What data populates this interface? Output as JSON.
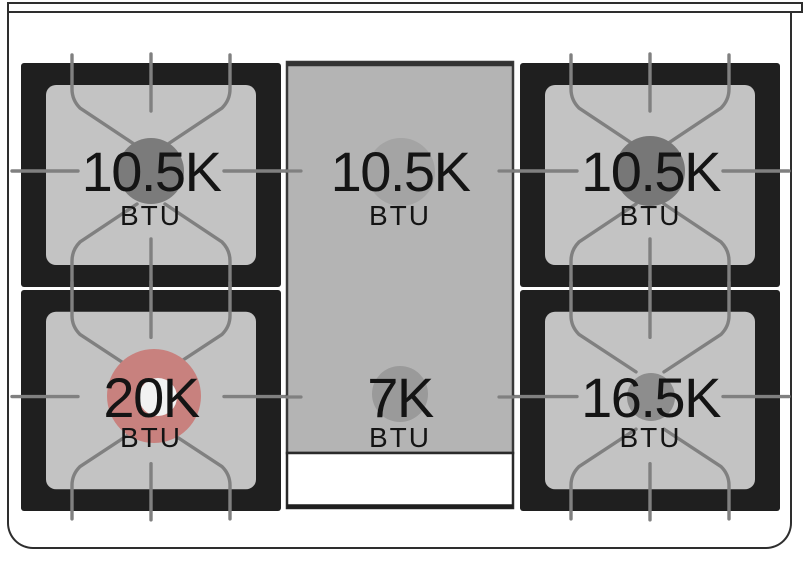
{
  "diagram": {
    "name": "gas-range-cooktop-burner-layout"
  },
  "burners": [
    {
      "position": "rear-left",
      "value": "10.5K",
      "unit": "BTU",
      "circle_color": "#7b7b7b"
    },
    {
      "position": "center-rear",
      "value": "10.5K",
      "unit": "BTU",
      "circle_color": "#a4a4a4"
    },
    {
      "position": "rear-right",
      "value": "10.5K",
      "unit": "BTU",
      "circle_color": "#777777"
    },
    {
      "position": "front-left",
      "value": "20K",
      "unit": "BTU",
      "circle_color": "#c8817e",
      "inner_color": "#f2f2f2"
    },
    {
      "position": "center-front",
      "value": "7K",
      "unit": "BTU",
      "circle_color": "#9a9a9a"
    },
    {
      "position": "front-right",
      "value": "16.5K",
      "unit": "BTU",
      "circle_color": "#8d8d8d"
    }
  ],
  "colors": {
    "grate_frame": "#1f1f1f",
    "burner_surface": "#c3c3c3",
    "center_surface": "#b4b4b4",
    "grate_lines": "#808080",
    "drip_tray": "#ffffff",
    "outline": "#2e2e2e"
  }
}
